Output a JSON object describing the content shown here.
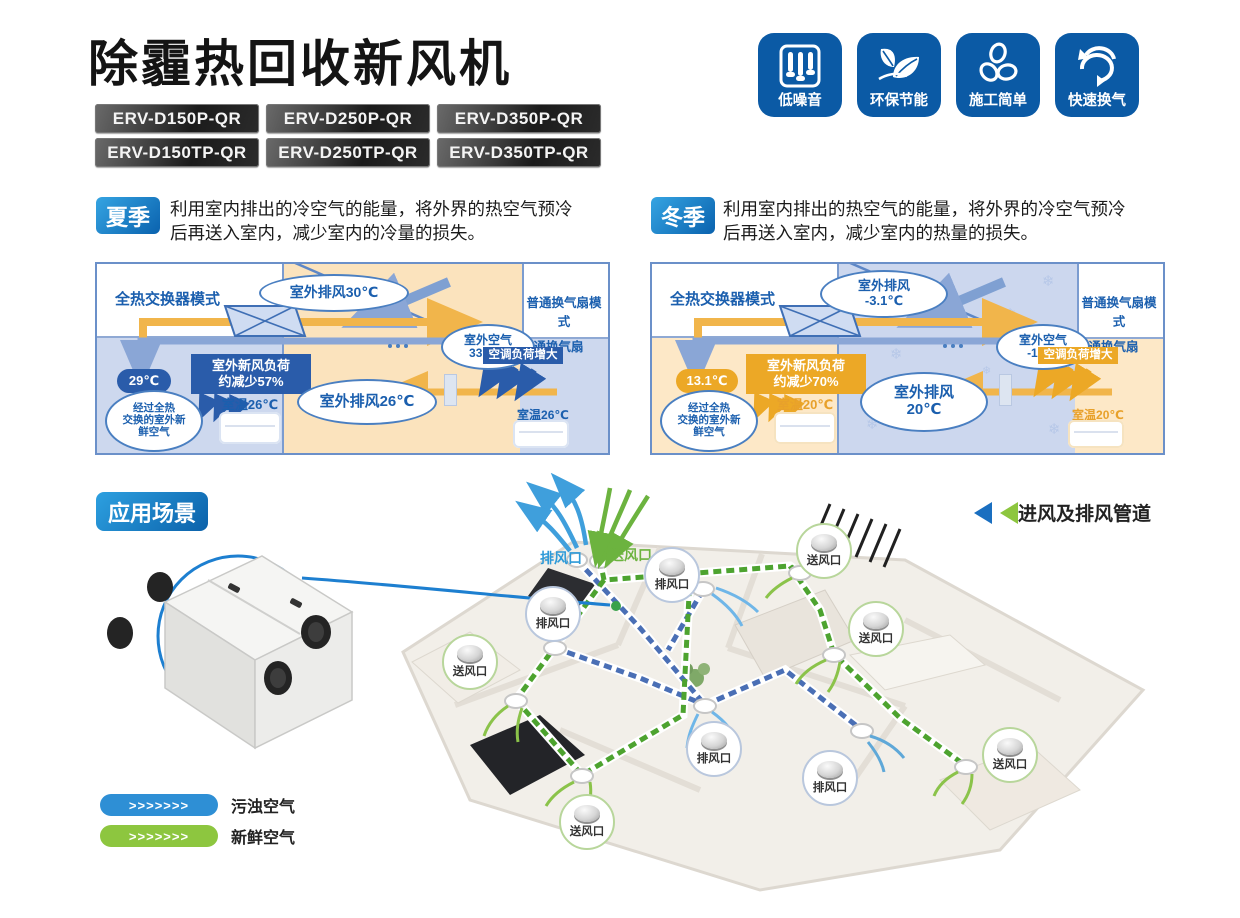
{
  "header": {
    "title": "除霾热回收新风机",
    "models": [
      "ERV-D150P-QR",
      "ERV-D250P-QR",
      "ERV-D350P-QR",
      "ERV-D150TP-QR",
      "ERV-D250TP-QR",
      "ERV-D350TP-QR"
    ],
    "features": [
      {
        "label": "低噪音",
        "icon": "noise-slider-icon"
      },
      {
        "label": "环保节能",
        "icon": "leaf-icon"
      },
      {
        "label": "施工简单",
        "icon": "fan-blade-icon"
      },
      {
        "label": "快速换气",
        "icon": "cycle-arrow-icon"
      }
    ]
  },
  "summer": {
    "badge": "夏季",
    "desc_line1": "利用室内排出的冷空气的能量，将外界的热空气预冷",
    "desc_line2": "后再送入室内，减少室内的冷量的损失。",
    "diagram": {
      "left_mode": "全热交换器模式",
      "right_mode": "普通换气扇模式",
      "fan_label": "普通换气扇",
      "exhaust_top": "室外排风30℃",
      "outdoor_air_l1": "室外空气",
      "outdoor_air_l2": "33.2℃",
      "load_l1": "室外新风负荷",
      "load_l2": "约减少57%",
      "supply_temp": "29℃",
      "supply_note_l1": "经过全热",
      "supply_note_l2": "交换的室外新",
      "supply_note_l3": "鲜空气",
      "room_temp_left": "室温26℃",
      "exhaust_bottom": "室外排风26℃",
      "ac_load": "空调负荷增大",
      "room_temp_right": "室温26℃"
    }
  },
  "winter": {
    "badge": "冬季",
    "desc_line1": "利用室内排出的热空气的能量，将外界的冷空气预冷",
    "desc_line2": "后再送入室内，减少室内的热量的损失。",
    "diagram": {
      "left_mode": "全热交换器模式",
      "right_mode": "普通换气扇模式",
      "fan_label": "普通换气扇",
      "exhaust_top_l1": "室外排风",
      "exhaust_top_l2": "-3.1℃",
      "outdoor_air_l1": "室外空气",
      "outdoor_air_l2": "-10℃",
      "load_l1": "室外新风负荷",
      "load_l2": "约减少70%",
      "supply_temp": "13.1℃",
      "supply_note_l1": "经过全热",
      "supply_note_l2": "交换的室外新",
      "supply_note_l3": "鲜空气",
      "room_temp_left": "室温20℃",
      "exhaust_bottom_l1": "室外排风",
      "exhaust_bottom_l2": "20℃",
      "ac_load": "空调负荷增大",
      "room_temp_right": "室温20℃"
    }
  },
  "application": {
    "badge": "应用场景",
    "duct_caption": "进风及排风管道",
    "vents": [
      {
        "label": "排风口",
        "type": "exhaust",
        "style": "plain"
      },
      {
        "label": "送风口",
        "type": "supply",
        "style": "plain"
      },
      {
        "label": "排风口",
        "type": "exhaust",
        "style": "bubble"
      },
      {
        "label": "排风口",
        "type": "exhaust",
        "style": "bubble"
      },
      {
        "label": "送风口",
        "type": "supply",
        "style": "bubble"
      },
      {
        "label": "送风口",
        "type": "supply",
        "style": "bubble"
      },
      {
        "label": "送风口",
        "type": "supply",
        "style": "bubble"
      },
      {
        "label": "排风口",
        "type": "exhaust",
        "style": "bubble"
      },
      {
        "label": "排风口",
        "type": "exhaust",
        "style": "bubble"
      },
      {
        "label": "送风口",
        "type": "supply",
        "style": "bubble"
      },
      {
        "label": "送风口",
        "type": "supply",
        "style": "bubble"
      }
    ],
    "legend": [
      {
        "chevrons": ">>>>>>>",
        "label": "污浊空气",
        "color": "#2e8fd5"
      },
      {
        "chevrons": ">>>>>>>",
        "label": "新鲜空气",
        "color": "#8dc63f"
      }
    ]
  },
  "colors": {
    "primary_blue": "#0b5aa5",
    "badge_gradient_start": "#2da0e0",
    "badge_gradient_end": "#0b61aa",
    "summer_outdoor": "#fbe3bd",
    "summer_indoor": "#cdd8ee",
    "winter_outdoor": "#ccd7ee",
    "winter_indoor": "#fde8c7",
    "accent_blue_box": "#2a5caa",
    "accent_orange_box": "#eca826",
    "exhaust_duct": "#4a6fb5",
    "supply_duct": "#4da32f"
  }
}
